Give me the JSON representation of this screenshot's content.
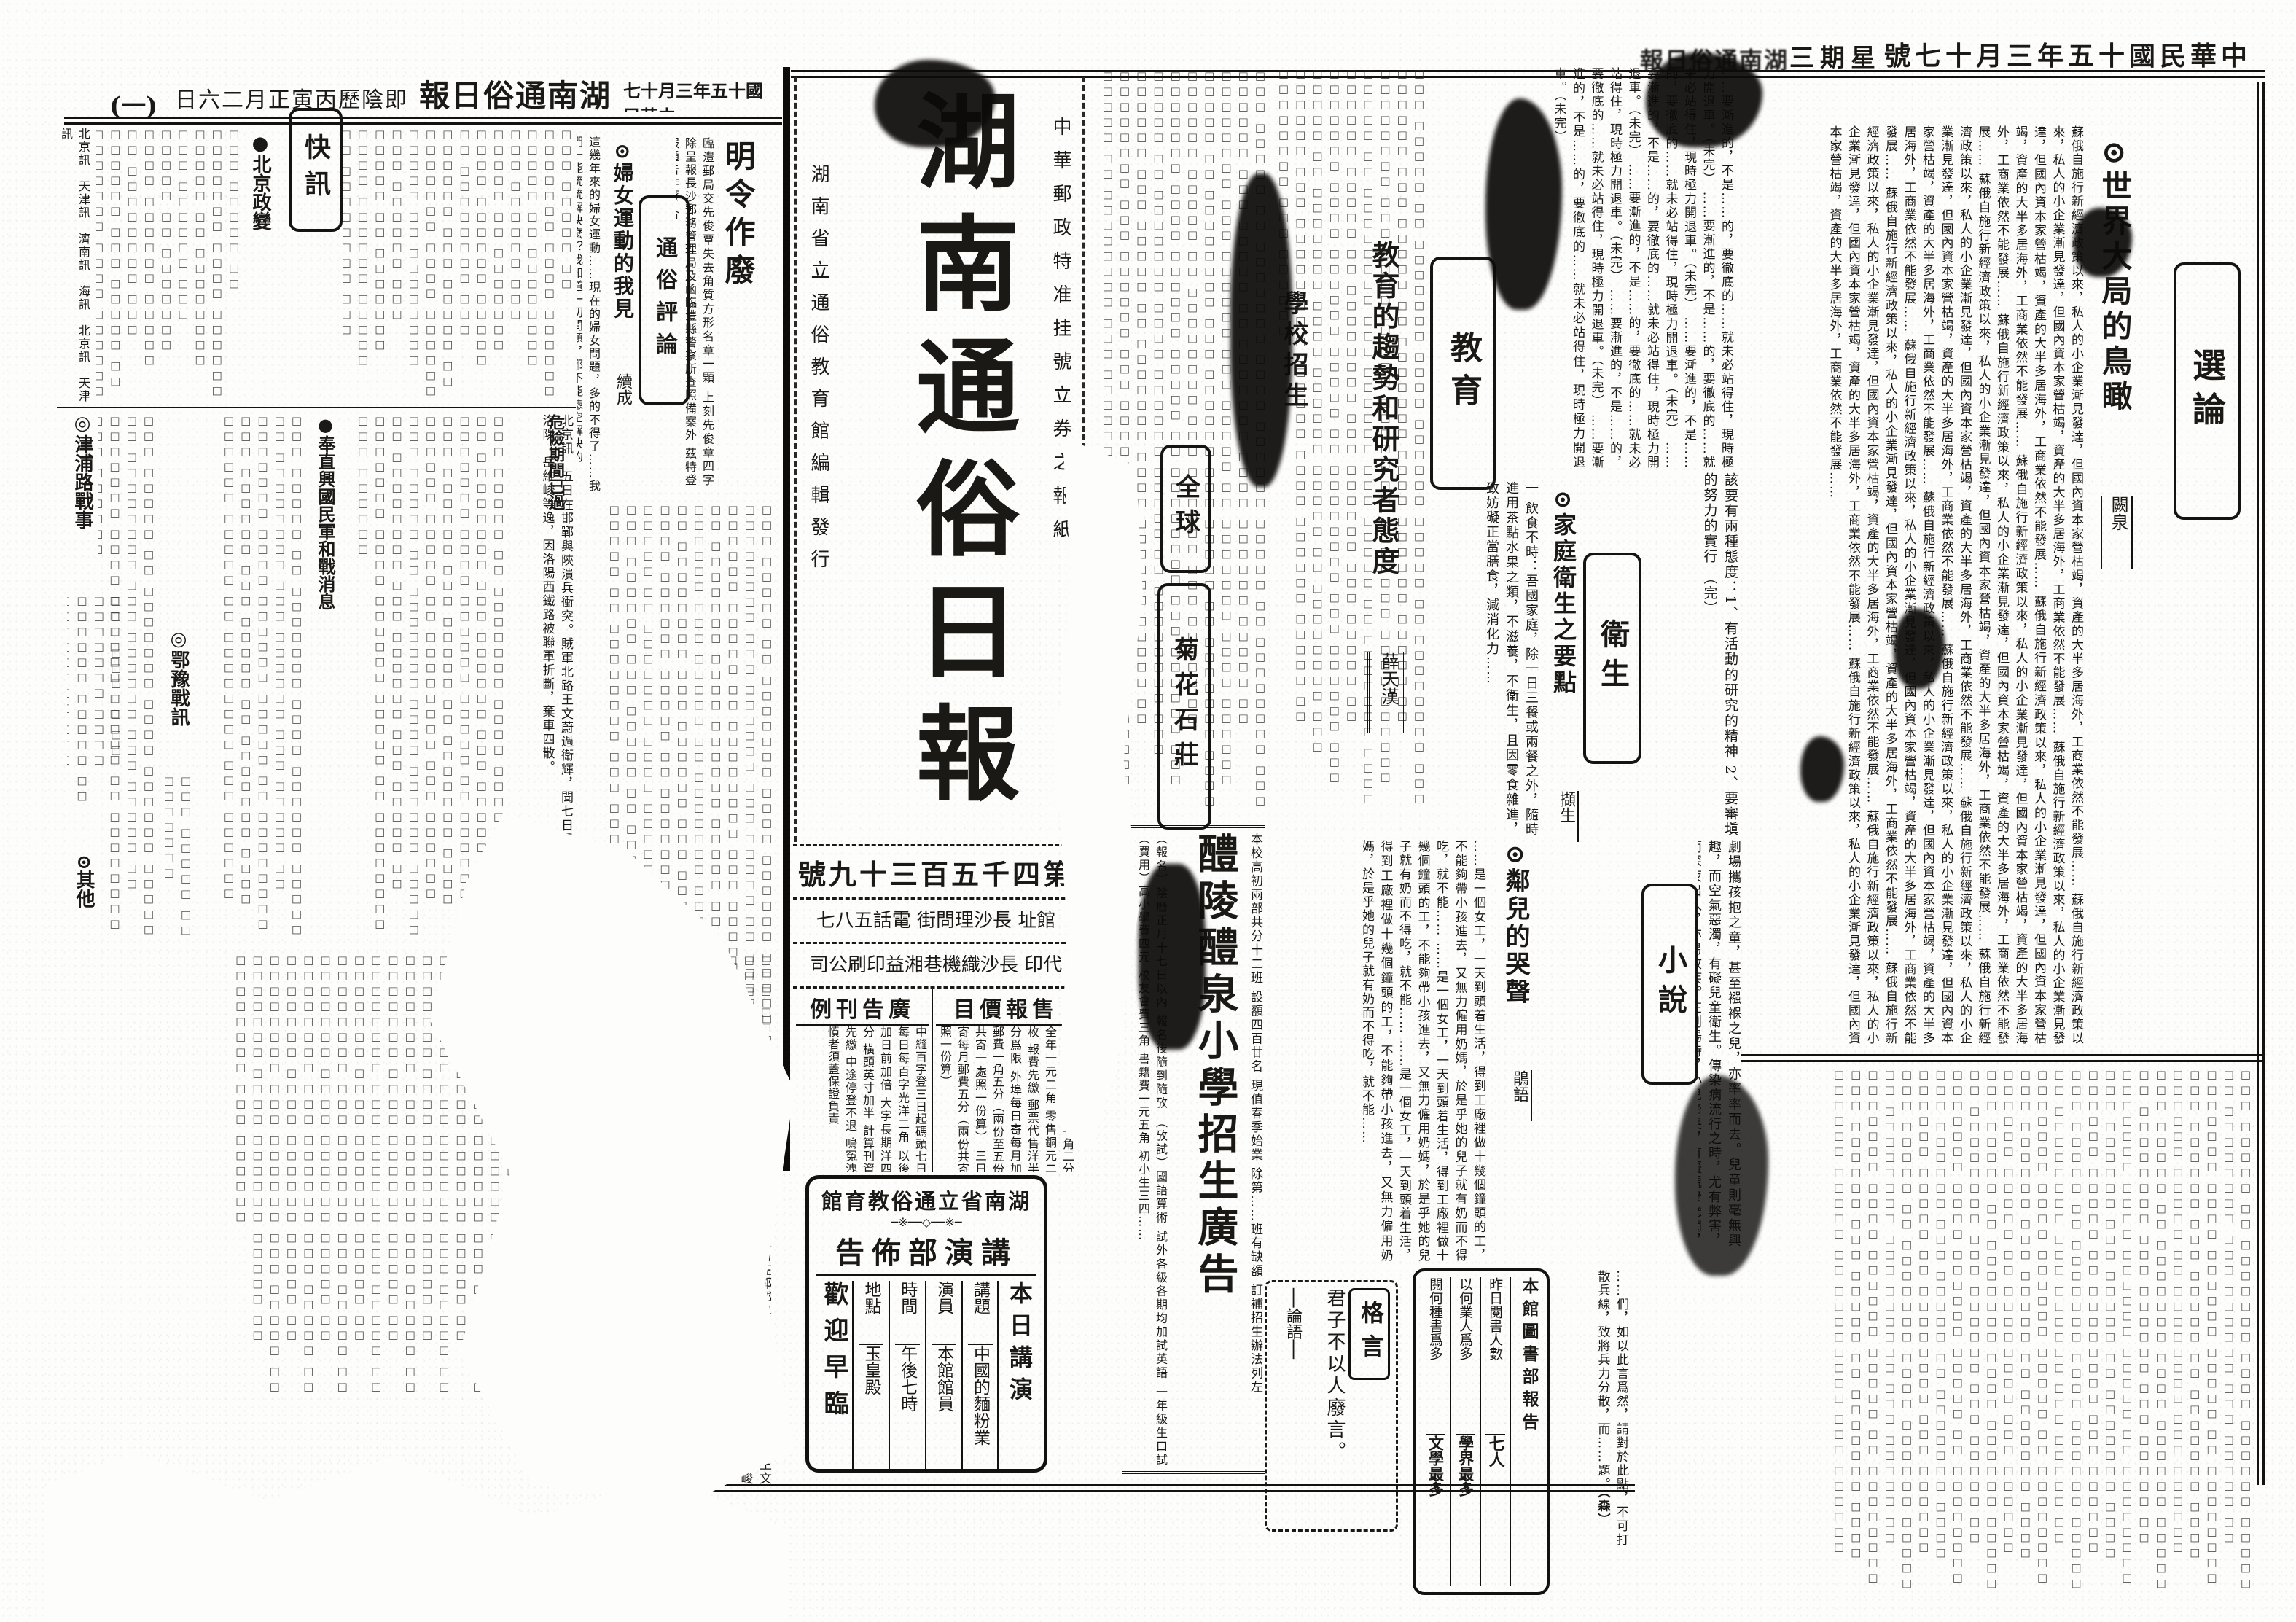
{
  "page_meta": {
    "right_header": {
      "date": "中華民國十五年三月十七號",
      "weekday": "星期三",
      "paper": "湖南通俗日報"
    },
    "left_header": {
      "date": "中華民國十五年三月十七",
      "paper": "湖南通俗日報",
      "lunar": "即陰歷丙寅正月二六日",
      "page_no": "(一)"
    }
  },
  "masthead": {
    "title": "湖南通俗日報",
    "postal_note": "中華郵政特准挂號立券之報紙",
    "publisher_note": "湖南省立通俗教育館編輯發行",
    "issue_no": "第四千五百三十九號",
    "address_line": "館址 長沙理問街 電話五八七",
    "printer_line": "代印 長沙織機巷湘益印刷公司"
  },
  "price_box": {
    "title": "售報價目",
    "text": "本埠每月每份光洋一角二分 全年一元二角 零售銅元二枚 報費先繳 郵票代售洋半分爲限 外埠每日寄每月加郵費一角五分（兩份至五份共寄一處照一份算） 三日寄每月郵費五分（兩份共寄照一份算）"
  },
  "ad_rates_box": {
    "title": "廣告刊例",
    "text": "中縫百字登三日起碼頭七日 每日每百字光洋二角 以後加日前加倍 大字長期洋四分 橫頭英寸加半 計算刊資先繳 中途停登不退 鳴冤洩憤者須蓋保證負責"
  },
  "selected_essay": {
    "section": "選論",
    "title": "⊙世界大局的鳥瞰",
    "author": "闕泉",
    "excerpt": "蘇俄自施行新經濟政策以來，私人的小企業漸見發達，但國內資本家營枯竭，資產的大半多居海外，工商業依然不能發展……"
  },
  "education": {
    "section": "教育",
    "notice_title": "學校招生",
    "article_title": "教育的趨勢和研究者態度",
    "author": "薛天漢",
    "excerpt": "……要漸進的，不是……的，要徹底的……就未必站得住，現時極力開退車。（未完）",
    "attitudes": "該要有兩種態度：1、有活動的研究的精神 2、要審塡的努力的實行 （完）"
  },
  "hygiene": {
    "section": "衛生",
    "title": "⊙家庭衛生之要點",
    "author": "擷生",
    "excerpt": "一 飲食不時：吾國家庭，除一日三餐或兩餐之外，隨時進用茶點水果之類，不滋養，不衛生，且因零食雜進，致妨礙正當膳食，減消化力……",
    "excerpt2": "劇場攜孩抱之童，甚至襁褓之兒，亦率率而去。兒童則毫無興趣，而空氣惡濁，有礙兒童衛生。傳染病流行之時，尤有弊害，而深夜出入，亦易致疾。在劇場時，小兒啼哭，有礙觀衆聽聞，易招厭惡，此則於己於人，有害無利，允宜改革之。"
  },
  "fiction": {
    "section": "小說",
    "title": "⊙鄰兒的哭聲",
    "author": "鵑語",
    "excerpt": "……是一個女工，一天到頭着生活，得到工廠裡做十幾個鐘頭的工，不能夠帶小孩進去，又無力僱用奶媽，於是乎她的兒子就有奶而不得吃，就不能……"
  },
  "essay_end": {
    "excerpt": "……們，如以此言爲然，請對於此點，不可打散兵線，致將兵力分散，而……題。",
    "signature": "（森）"
  },
  "school_ad": {
    "title": "醴陵醴泉小學招生廣告",
    "intro": "本校高初兩部共分十二班 設額四百廿名 現值春季始業 除第……班有缺額 訂補招生辦法列左",
    "details": "（報名）陰曆正月十七日以內 報名後隨到隨攷 （攷試）國語算術 試外各級各期均加試英語 一年級生口試 （費用）高小學費四元 校友會費三角 書籍費一元五角 初小生三四……"
  },
  "lecture_box": {
    "org": "湖南省立通俗教育館",
    "ornament": "─※──◇──※─",
    "dept": "講演部佈告",
    "session": "本日講演",
    "rows": [
      {
        "label": "講題",
        "value": "中國的麵粉業"
      },
      {
        "label": "演員",
        "value": "本館館員"
      },
      {
        "label": "時間",
        "value": "午後七時"
      },
      {
        "label": "地點",
        "value": "玉皇殿"
      }
    ],
    "welcome": "歡迎早臨"
  },
  "library_box": {
    "title": "本館圖書部報告",
    "rows": [
      {
        "label": "昨日閱書人數",
        "value": "七人"
      },
      {
        "label": "以何業人爲多",
        "value": "學界最多"
      },
      {
        "label": "閱何種書爲多",
        "value": "文學最多"
      }
    ]
  },
  "maxim_box": {
    "title": "格言",
    "text": "君子不以人廢言。",
    "source": "──論語──"
  },
  "center_ads": {
    "ad1": "全球",
    "ad2": "菊花石莊"
  },
  "popular_review": {
    "section": "通俗評論",
    "title": "⊙婦女運動的我見",
    "subtitle": "續成",
    "excerpt": "這幾年來的婦女運動……現在的婦女問題，多的不得了……我們一能統統解決麼？我知道一切問題，都不能憑空解決的……"
  },
  "decree_notice": {
    "title": "明令作廢",
    "text": "臨澧郵局交先俊覃失去角質方形名章一顆 上刻先俊章四字 除呈報長沙郵務管理局及函臨澧縣警察所查照備案外 茲特登報通告作廢 合"
  },
  "flash_news": {
    "section": "快訊",
    "headlines": [
      "●北京政變",
      "危險期間已過",
      "●奉直興國民軍和戰消息",
      "◎津浦路戰事",
      "◎鄂豫戰訊",
      "⊙其他"
    ],
    "dateline_item": "北京訊　五日在邯鄲與陝潰兵衝突。賊軍北路王文蔚過衛輝，聞七日早西路王維城佔領洛陽，岳維峻等逸，因洛陽西鐵路被聯軍折斷，棄車四散。",
    "datelines": "北京訊　天津訊　濟南訊　海訊　北京訊　天津訊"
  },
  "filler": {
    "illegible": "□□□ □□□□□ □□ □□□□□□□ □□□□ □□□□□□ □□□□□ □□ □□□□□□□□ □□□ □□□□□□ "
  }
}
